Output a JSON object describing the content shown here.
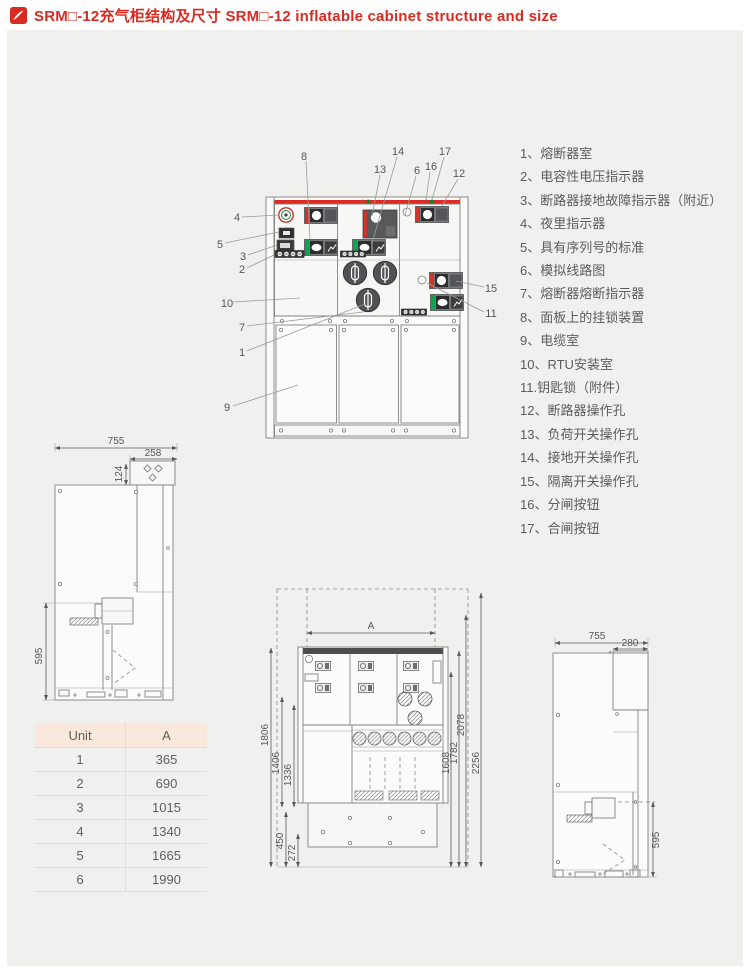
{
  "title": {
    "full": "SRM□-12充气柜结构及尺寸 SRM□-12 inflatable cabinet structure and size"
  },
  "colors": {
    "accent_red": "#d92b21",
    "green": "#12a150",
    "table_header_bg": "#fae8dc",
    "page_bg": "#f0f0ee"
  },
  "legend": {
    "items": [
      "1、熔断器室",
      "2、电容性电压指示器",
      "3、断路器接地故障指示器（附近）",
      "4、夜里指示器",
      "5、具有序列号的标准",
      "6、模拟线路图",
      "7、熔断器熔断指示器",
      "8、面板上的挂锁装置",
      "9、电缆室",
      "10、RTU安装室",
      "11.钥匙锁（附件）",
      "12、断路器操作孔",
      "13、负荷开关操作孔",
      "14、接地开关操作孔",
      "15、隔离开关操作孔",
      "16、分闸按钮",
      "17、合闸按钮"
    ]
  },
  "front_view": {
    "callouts": {
      "c1": "1",
      "c2": "2",
      "c3": "3",
      "c4": "4",
      "c5": "5",
      "c6": "6",
      "c7": "7",
      "c8": "8",
      "c9": "9",
      "c10": "10",
      "c11": "11",
      "c12": "12",
      "c13": "13",
      "c14": "14",
      "c15": "15",
      "c16": "16",
      "c17": "17"
    }
  },
  "side_view_left": {
    "dims": {
      "width": "755",
      "depth_top": "258",
      "height_top": "124",
      "height_bottom": "595"
    }
  },
  "spec_table": {
    "headers": [
      "Unit",
      "A"
    ],
    "rows": [
      [
        "1",
        "365"
      ],
      [
        "2",
        "690"
      ],
      [
        "3",
        "1015"
      ],
      [
        "4",
        "1340"
      ],
      [
        "5",
        "1665"
      ],
      [
        "6",
        "1990"
      ]
    ]
  },
  "front_dim_view": {
    "dims": {
      "a": "A",
      "left1": "1806",
      "left2": "1406",
      "left3": "1336",
      "right1": "1608",
      "right2": "1782",
      "right3": "2078",
      "right4": "2256",
      "bottom1": "450",
      "bottom2": "272"
    }
  },
  "side_view_right": {
    "dims": {
      "width": "755",
      "depth_top": "280",
      "height_top": "470",
      "height_bottom": "595"
    }
  }
}
